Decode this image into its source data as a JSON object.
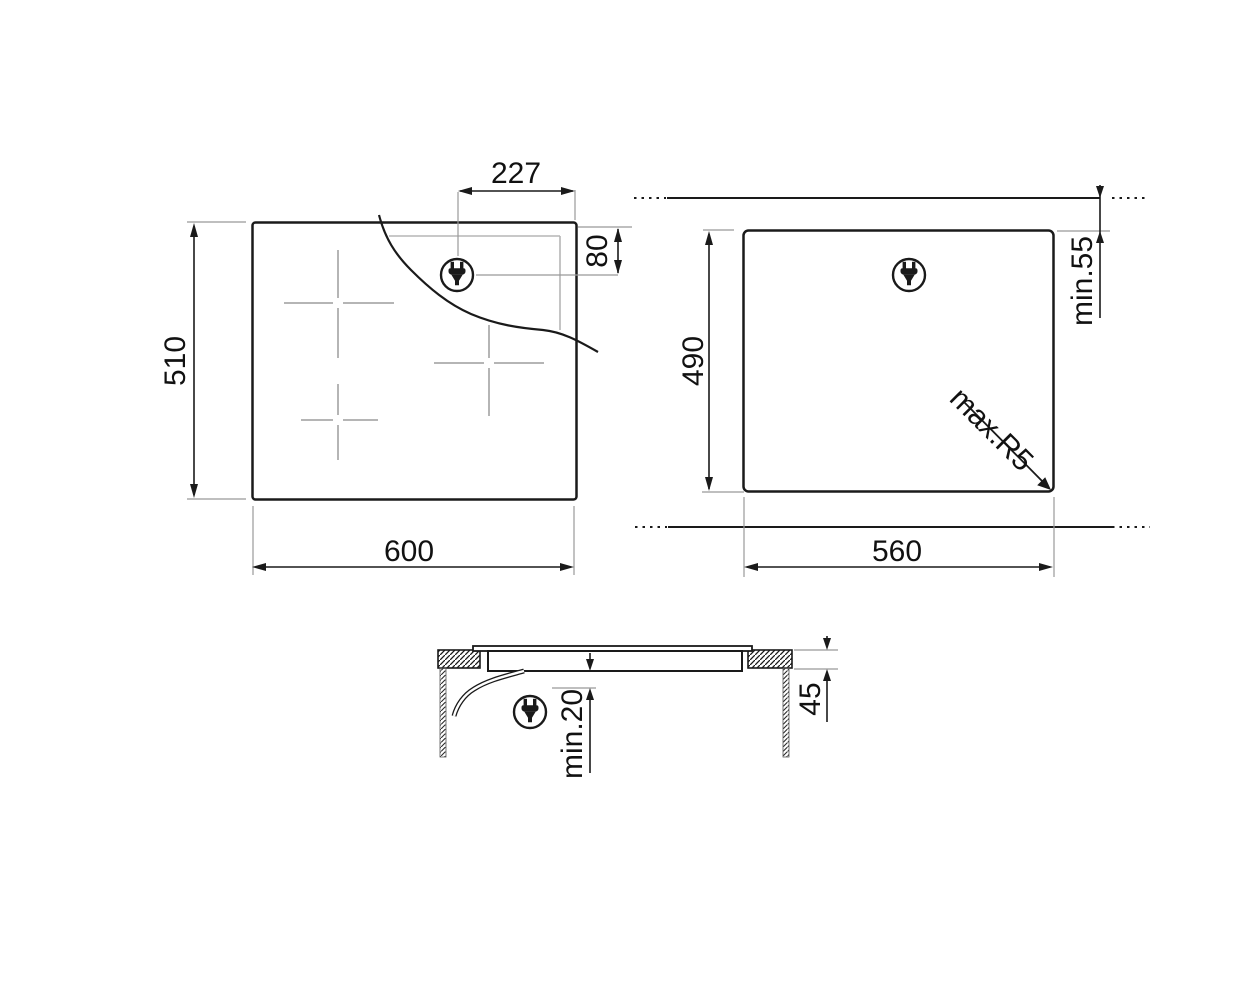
{
  "drawing": {
    "type": "hob-installation-dimension-drawing",
    "top_view": {
      "width": "600",
      "height": "510",
      "plug_offset_x": "227",
      "plug_offset_y": "80"
    },
    "cutout_view": {
      "width": "560",
      "height": "490",
      "rear_clearance": "min.55",
      "corner_radius": "max.R5"
    },
    "side_view": {
      "recess_depth": "45",
      "bottom_clearance": "min.20"
    },
    "icons": {
      "plug": "power-plug-icon"
    },
    "colors": {
      "line": "#1a1a1a",
      "extension_line": "#999999",
      "zone_marks": "#b5b5b5",
      "background": "#ffffff"
    }
  }
}
